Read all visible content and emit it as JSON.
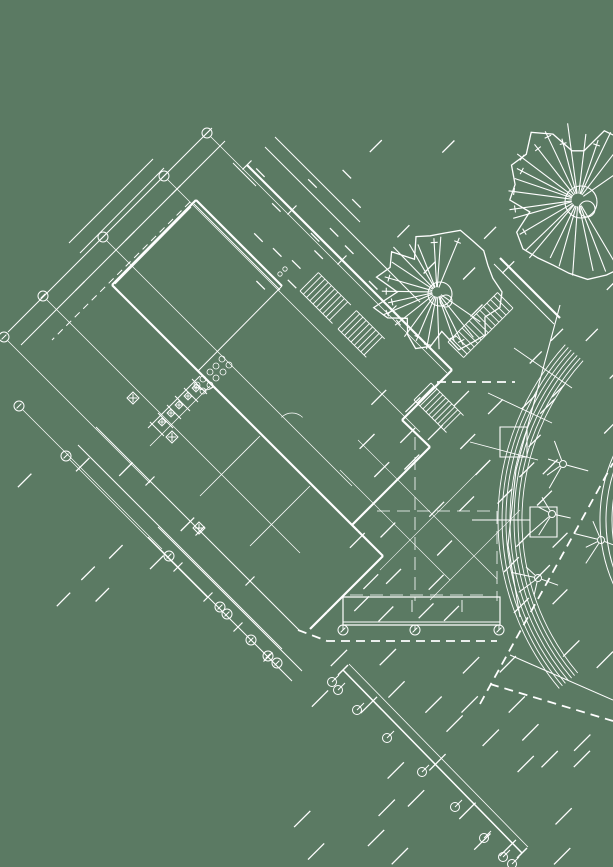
{
  "meta": {
    "width": 613,
    "height": 867,
    "colors": {
      "background": "#5b7a63",
      "line": "#ffffff"
    }
  },
  "drawing": {
    "layers": [
      {
        "name": "hatch-fields",
        "type": "hatch",
        "w": 1.3,
        "items": [
          {
            "x": 345,
            "y": 395,
            "wd": 215,
            "h": 205,
            "step": 34,
            "len": 21,
            "dir": "f",
            "density": 0.72,
            "seed": 7
          },
          {
            "x": 300,
            "y": 648,
            "wd": 313,
            "h": 219,
            "step": 38,
            "len": 23,
            "dir": "f",
            "density": 0.8,
            "seed": 11
          },
          {
            "x": 255,
            "y": 172,
            "wd": 115,
            "h": 115,
            "step": 27,
            "len": 12,
            "dir": "b",
            "density": 0.65,
            "seed": 3
          },
          {
            "x": 28,
            "y": 468,
            "wd": 175,
            "h": 175,
            "step": 44,
            "len": 19,
            "dir": "f",
            "density": 0.42,
            "seed": 5
          },
          {
            "x": 360,
            "y": 148,
            "wd": 155,
            "h": 175,
            "step": 40,
            "len": 17,
            "dir": "f",
            "density": 0.45,
            "seed": 9
          },
          {
            "x": 536,
            "y": 286,
            "wd": 77,
            "h": 170,
            "step": 36,
            "len": 17,
            "dir": "f",
            "density": 0.55,
            "seed": 13
          }
        ]
      },
      {
        "name": "grid-leader-lines",
        "type": "lines",
        "w": 0.7,
        "items": [
          [
            211,
            137,
            447,
            373
          ],
          [
            168,
            180,
            420,
            432
          ],
          [
            107,
            241,
            352,
            486
          ],
          [
            47,
            300,
            300,
            553
          ],
          [
            8,
            341,
            150,
            483
          ],
          [
            23,
            410,
            162,
            549
          ],
          [
            70,
            460,
            208,
            598
          ]
        ]
      },
      {
        "name": "centerlines",
        "type": "lines",
        "w": 0.8,
        "dash": "13,7",
        "items": [
          [
            415,
            437,
            415,
            601
          ],
          [
            377,
            511,
            497,
            511
          ],
          [
            497,
            511,
            497,
            601
          ],
          [
            350,
            595,
            490,
            595
          ]
        ]
      },
      {
        "name": "terrace-joint-lines",
        "type": "lines",
        "w": 0.6,
        "items": [
          [
            358,
            440,
            497,
            579
          ],
          [
            340,
            470,
            450,
            580
          ],
          [
            380,
            570,
            490,
            460
          ],
          [
            430,
            600,
            520,
            510
          ]
        ]
      },
      {
        "name": "dimension-lines",
        "type": "lines",
        "w": 1,
        "items": [
          [
            212,
            128,
            8,
            332
          ],
          [
            225,
            141,
            21,
            345
          ],
          [
            148,
            537,
            292,
            681
          ],
          [
            158,
            527,
            302,
            671
          ],
          [
            96,
            427,
            300,
            631
          ],
          [
            78,
            445,
            282,
            649
          ]
        ]
      },
      {
        "name": "walls-heavy",
        "type": "lines",
        "w": 2.2,
        "items": [
          [
            247,
            165,
            452,
            370
          ],
          [
            452,
            370,
            402,
            420
          ],
          [
            402,
            420,
            430,
            447
          ],
          [
            430,
            447,
            352,
            525
          ],
          [
            112,
            285,
            358,
            531
          ],
          [
            358,
            531,
            383,
            556
          ],
          [
            383,
            556,
            327,
            612
          ],
          [
            327,
            612,
            310,
            629
          ],
          [
            196,
            200,
            282,
            286
          ],
          [
            196,
            200,
            112,
            285
          ],
          [
            500,
            258,
            560,
            318
          ]
        ]
      },
      {
        "name": "walls-light",
        "type": "lines",
        "w": 1,
        "items": [
          [
            194,
            204,
            280,
            290
          ],
          [
            191,
            207,
            115,
            284
          ],
          [
            282,
            286,
            198,
            371
          ],
          [
            265,
            147,
            420,
            302
          ],
          [
            275,
            137,
            360,
            222
          ],
          [
            164,
            168,
            80,
            253
          ],
          [
            153,
            159,
            69,
            243
          ],
          [
            494,
            264,
            554,
            324
          ],
          [
            510,
            655,
            613,
            700
          ],
          [
            233,
            163,
            256,
            186
          ],
          [
            148,
            428,
            200,
            376
          ]
        ]
      },
      {
        "name": "interior-stubs",
        "type": "lines",
        "w": 0.8,
        "items": [
          [
            150,
            446,
            210,
            386
          ],
          [
            200,
            496,
            260,
            436
          ],
          [
            250,
            546,
            310,
            486
          ]
        ]
      },
      {
        "name": "stairs",
        "type": "stairs",
        "w": 0.9,
        "items": [
          {
            "x": 300,
            "y": 291,
            "len": 46,
            "wd": 26,
            "step": 4.6,
            "dir": "se"
          },
          {
            "x": 338,
            "y": 329,
            "len": 40,
            "wd": 26,
            "step": 4.6,
            "dir": "se"
          },
          {
            "x": 414,
            "y": 400,
            "len": 46,
            "wd": 24,
            "step": 4.2,
            "dir": "se"
          },
          {
            "x": 448,
            "y": 342,
            "len": 70,
            "wd": 22,
            "step": 5,
            "dir": "ne"
          }
        ]
      },
      {
        "name": "curved-band-outer",
        "type": "fan_arcs",
        "w": 0.9,
        "c": [
          760,
          520
        ],
        "radii": [
          238,
          242,
          246,
          250,
          254,
          258,
          262
        ],
        "a1": 140,
        "a2": 222
      },
      {
        "name": "curved-band-inner",
        "type": "fan_arcs",
        "w": 1,
        "c": [
          760,
          520
        ],
        "radii": [
          148,
          154,
          160
        ],
        "a1": 150,
        "a2": 212
      },
      {
        "name": "band-radials",
        "type": "lines",
        "w": 0.9,
        "items": [
          [
            538,
            460,
            470,
            442
          ],
          [
            552,
            423,
            488,
            393
          ],
          [
            572,
            388,
            514,
            348
          ],
          [
            530,
            520,
            472,
            520
          ]
        ]
      },
      {
        "name": "band-chord",
        "type": "polylines",
        "w": 1.1,
        "items": [
          [
            [
              560,
              305
            ],
            [
              516,
              470
            ],
            [
              508,
              545
            ],
            [
              520,
              617
            ]
          ]
        ]
      },
      {
        "name": "planter-rects",
        "type": "rects",
        "w": 1.1,
        "items": [
          [
            500,
            427,
            27,
            30
          ],
          [
            530,
            507,
            27,
            30
          ]
        ]
      },
      {
        "name": "colonnade-rect",
        "type": "rects",
        "w": 1.2,
        "items": [
          [
            343,
            597,
            157,
            28
          ]
        ]
      },
      {
        "name": "colonnade-lines",
        "type": "lines",
        "w": 0.9,
        "items": [
          [
            343,
            622,
            500,
            622
          ],
          [
            343,
            625,
            343,
            630
          ],
          [
            415,
            625,
            415,
            630
          ],
          [
            499,
            625,
            499,
            630
          ],
          [
            412,
            600,
            412,
            612
          ],
          [
            462,
            600,
            462,
            612
          ]
        ]
      },
      {
        "name": "fence-lines",
        "type": "lines",
        "w": 1.5,
        "items": [
          [
            343,
            670,
            522,
            853
          ],
          [
            338,
            675,
            348,
            665
          ],
          [
            517,
            858,
            527,
            848
          ]
        ]
      },
      {
        "name": "fence-line-2",
        "type": "lines",
        "w": 0.8,
        "items": [
          [
            349,
            664,
            528,
            847
          ]
        ]
      },
      {
        "name": "fence-posts",
        "type": "posts",
        "r": 4.5,
        "w": 1,
        "items": [
          [
            332,
            682
          ],
          [
            338,
            690
          ],
          [
            357,
            710
          ],
          [
            387,
            738
          ],
          [
            422,
            772
          ],
          [
            455,
            807
          ],
          [
            484,
            838
          ],
          [
            503,
            857
          ],
          [
            512,
            864
          ]
        ]
      },
      {
        "name": "boundary-dashed",
        "type": "lines",
        "w": 1.8,
        "dash": "9,6",
        "items": [
          [
            480,
            704,
            613,
            463
          ],
          [
            490,
            684,
            613,
            721
          ],
          [
            437,
            382,
            515,
            382
          ]
        ]
      },
      {
        "name": "boundary-dashed-poly",
        "type": "polylines",
        "w": 1.8,
        "dash": "9,6",
        "items": [
          [
            [
              298,
              630
            ],
            [
              327,
              641
            ],
            [
              497,
              641
            ]
          ]
        ]
      },
      {
        "name": "centerline-dashed",
        "type": "lines",
        "w": 1,
        "dash": "7,5",
        "items": [
          [
            190,
            202,
            52,
            340
          ]
        ]
      },
      {
        "name": "ticks",
        "type": "ticks",
        "len": 9,
        "w": 1.2,
        "items": [
          [
            176,
            190
          ],
          [
            130,
            236
          ],
          [
            80,
            286
          ],
          [
            178,
            567
          ],
          [
            208,
            597
          ],
          [
            238,
            627
          ],
          [
            268,
            657
          ],
          [
            150,
            481
          ],
          [
            200,
            531
          ],
          [
            250,
            581
          ],
          [
            292,
            210
          ],
          [
            342,
            260
          ],
          [
            392,
            310
          ],
          [
            247,
            165
          ]
        ]
      },
      {
        "name": "grid-bubbles",
        "type": "bubbles",
        "r": 5,
        "w": 1,
        "items": [
          [
            207,
            133
          ],
          [
            164,
            176
          ],
          [
            103,
            237
          ],
          [
            43,
            296
          ],
          [
            4,
            337
          ],
          [
            19,
            406
          ],
          [
            66,
            456
          ],
          [
            169,
            556
          ],
          [
            220,
            607
          ],
          [
            227,
            614
          ],
          [
            251,
            640
          ],
          [
            268,
            656
          ],
          [
            277,
            663
          ],
          [
            343,
            630
          ],
          [
            415,
            630
          ],
          [
            499,
            630
          ]
        ]
      },
      {
        "name": "column-markers",
        "type": "diamonds",
        "w": 1,
        "items": [
          [
            133,
            398,
            6
          ],
          [
            172,
            437,
            6
          ],
          [
            199,
            528,
            6
          ]
        ]
      },
      {
        "name": "fixture-partitions",
        "type": "lines",
        "w": 1,
        "items": [
          [
            150,
            422,
            164,
            436
          ],
          [
            158,
            413,
            173,
            428
          ],
          [
            167,
            405,
            181,
            419
          ],
          [
            175,
            396,
            190,
            411
          ],
          [
            184,
            388,
            198,
            402
          ],
          [
            192,
            379,
            207,
            394
          ]
        ]
      },
      {
        "name": "fixture-bowls",
        "type": "diamonds",
        "w": 0.9,
        "items": [
          [
            162,
            422,
            4
          ],
          [
            171,
            413,
            4
          ],
          [
            179,
            405,
            4
          ],
          [
            188,
            396,
            4
          ],
          [
            196,
            388,
            4
          ]
        ]
      },
      {
        "name": "fixture-lavatories",
        "type": "circles",
        "r": 3,
        "w": 0.8,
        "items": [
          [
            197,
            385
          ],
          [
            203,
            379
          ],
          [
            210,
            372
          ],
          [
            216,
            366
          ],
          [
            222,
            359
          ],
          [
            203,
            391
          ],
          [
            210,
            385
          ],
          [
            216,
            378
          ],
          [
            223,
            372
          ],
          [
            229,
            365
          ]
        ]
      },
      {
        "name": "door-swings",
        "type": "arcs",
        "w": 0.8,
        "items": [
          {
            "c": [
              292,
              428
            ],
            "r": 15,
            "a1": 225,
            "a2": 315
          },
          {
            "c": [
              205,
              377
            ],
            "r": 13,
            "a1": 45,
            "a2": 135
          }
        ]
      },
      {
        "name": "room-tag-glyph",
        "type": "circles",
        "r": 2.2,
        "w": 0.8,
        "items": [
          [
            280,
            274
          ],
          [
            285,
            269
          ]
        ]
      },
      {
        "name": "plant-points",
        "type": "points",
        "w": 1,
        "seed": 31,
        "items": [
          [
            563,
            464
          ],
          [
            552,
            514
          ],
          [
            538,
            578
          ],
          [
            601,
            540
          ]
        ]
      },
      {
        "name": "trees",
        "type": "trees",
        "w": 1.1,
        "items": [
          {
            "cx": 578,
            "cy": 200,
            "r": 80,
            "trunk": 16,
            "spokes": 24,
            "seed": 21,
            "a0": 55,
            "a1": 330
          },
          {
            "cx": 437,
            "cy": 292,
            "r": 64,
            "trunk": 12,
            "spokes": 20,
            "seed": 22,
            "a0": 30,
            "a1": 300
          }
        ]
      }
    ]
  }
}
